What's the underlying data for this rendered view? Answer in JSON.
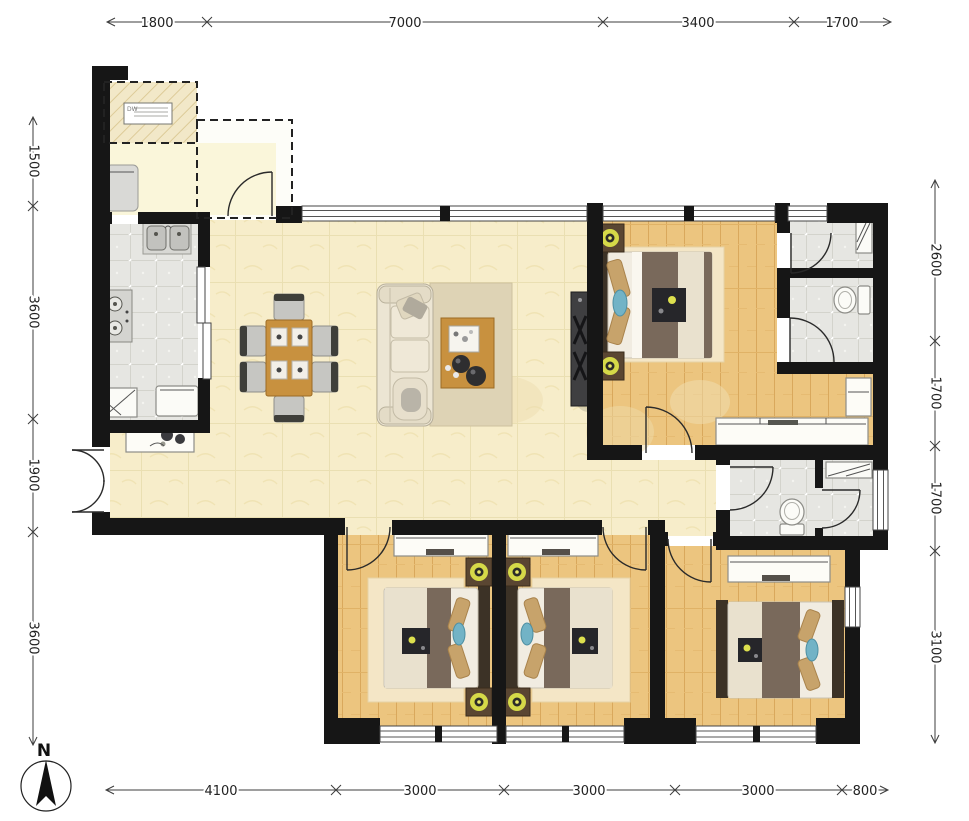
{
  "compass": {
    "label": "N"
  },
  "dimensions": {
    "top": [
      "1800",
      "7000",
      "3400",
      "1700"
    ],
    "bottom": [
      "4100",
      "3000",
      "3000",
      "3000",
      "800"
    ],
    "left": [
      "1500",
      "3600",
      "1900",
      "3600"
    ],
    "right": [
      "2600",
      "1700",
      "1700",
      "3100"
    ]
  },
  "porch": {
    "ac_label": "DW"
  },
  "colors": {
    "wall": "#161616",
    "beige_floor": "#f7edca",
    "wood_floor": "#ecc57f",
    "tile_floor": "#e6e6e2",
    "cream_floor": "#faf6da",
    "lamp_accent": "#d5d948",
    "pillow_blue": "#72b3c6",
    "blanket_brown": "#79695b",
    "table_wood": "#c8913f",
    "dim_line": "#3c3c3c"
  }
}
